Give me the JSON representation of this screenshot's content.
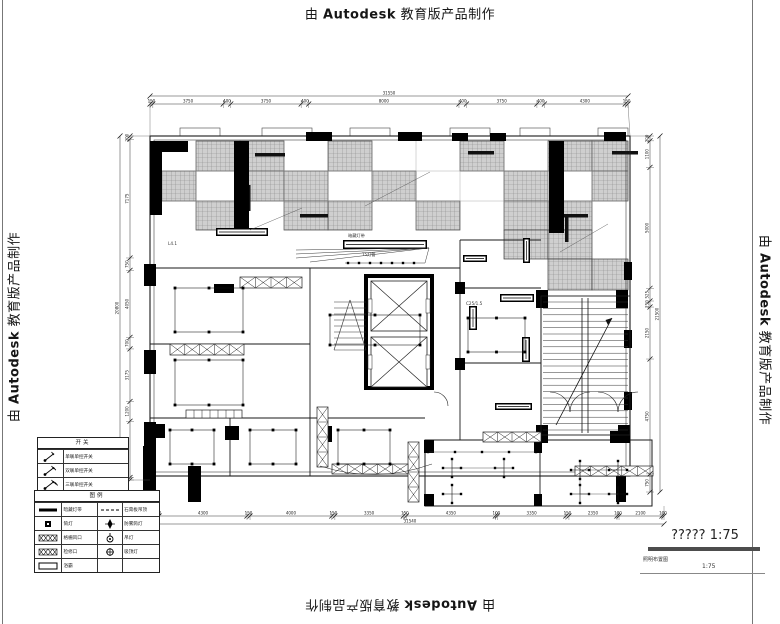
{
  "watermark": {
    "prefix": "由",
    "brand": "Autodesk",
    "suffix": "教育版产品制作"
  },
  "title_block": {
    "title": "????? 1:75",
    "drawing_name": "照明布置图",
    "scale": "1:75"
  },
  "colors": {
    "paper": "#ffffff",
    "ink": "#1a1a1a",
    "tile_fill": "#cfcfcf",
    "title_bar": "#4d4d4d"
  },
  "dimensions": {
    "top": {
      "total": "31550",
      "segments": [
        "150",
        "3750",
        "400",
        "3750",
        "400",
        "8000",
        "400",
        "3750",
        "400",
        "4300",
        "150"
      ]
    },
    "bottom": {
      "total": "31540",
      "segments": [
        "150",
        "4300",
        "150",
        "4000",
        "150",
        "3350",
        "150",
        "4350",
        "100",
        "3350",
        "150",
        "2350",
        "100",
        "2100",
        "100"
      ]
    },
    "left": {
      "total": "20800",
      "segments": [
        "200",
        "7175",
        "750",
        "4050",
        "700",
        "3175",
        "1200",
        "3400",
        "150"
      ]
    },
    "right": {
      "total": "21500",
      "segments": [
        "200",
        "1100",
        "5000",
        "525",
        "250",
        "2150",
        "4750",
        "750"
      ]
    }
  },
  "legend_switches": {
    "header": "开关",
    "rows": [
      {
        "symbol": "switch-1",
        "label": "单联单控开关"
      },
      {
        "symbol": "switch-2",
        "label": "双联单控开关"
      },
      {
        "symbol": "switch-3",
        "label": "三联单控开关"
      }
    ]
  },
  "legend_main": {
    "header": "图例",
    "rows": [
      {
        "sym1": "thick-line",
        "label1": "暗藏灯带",
        "sym2": "dashed-line",
        "label2": "石膏板吊顶"
      },
      {
        "sym1": "black-square",
        "label1": "筒灯",
        "sym2": "spot",
        "label2": "防雾筒灯"
      },
      {
        "sym1": "hatch-strip",
        "label1": "格栅风口",
        "sym2": "pendant",
        "label2": "吊灯"
      },
      {
        "sym1": "hatch-strip",
        "label1": "检修口",
        "sym2": "ceiling-lamp",
        "label2": "吸顶灯"
      },
      {
        "sym1": "open-rect",
        "label1": "浴霸",
        "sym2": "",
        "label2": ""
      }
    ]
  },
  "annotations": {
    "a1": "暗藏灯带",
    "a2": "L4.1",
    "a3": "T5灯管",
    "a4": "C25/1.5"
  }
}
